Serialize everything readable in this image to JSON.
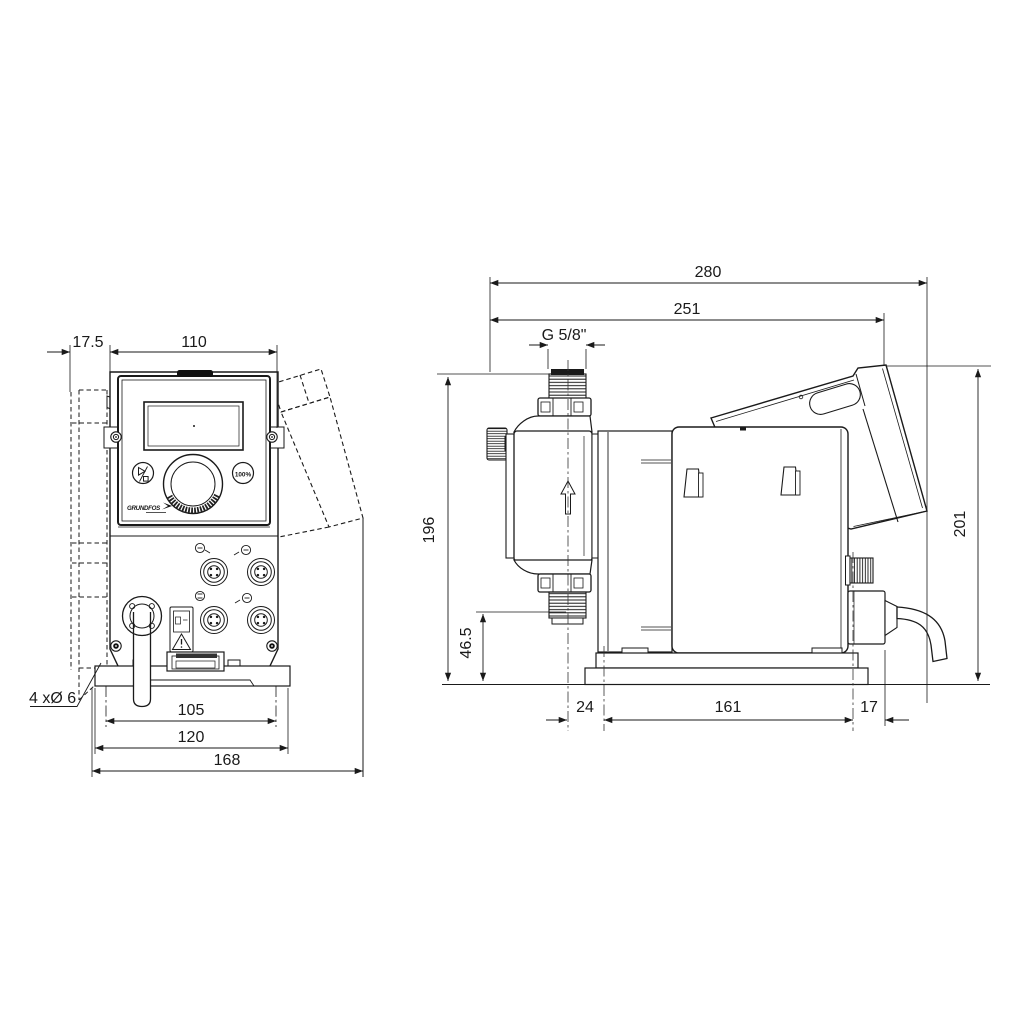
{
  "drawing": {
    "type": "technical-dimension-drawing",
    "subject": "dosing pump, front and side views",
    "line_color": "#1a1a1a",
    "background": "#ffffff"
  },
  "dims": {
    "d175": "17.5",
    "d110": "110",
    "d105": "105",
    "d120": "120",
    "d168": "168",
    "holes": "4 xØ 6",
    "d280": "280",
    "d251": "251",
    "g58": "G 5/8\"",
    "d196": "196",
    "d465": "46.5",
    "d201": "201",
    "d24": "24",
    "d161": "161",
    "d17": "17"
  },
  "panel": {
    "capacity_button": "100%",
    "logo": "GRUNDFOS"
  }
}
